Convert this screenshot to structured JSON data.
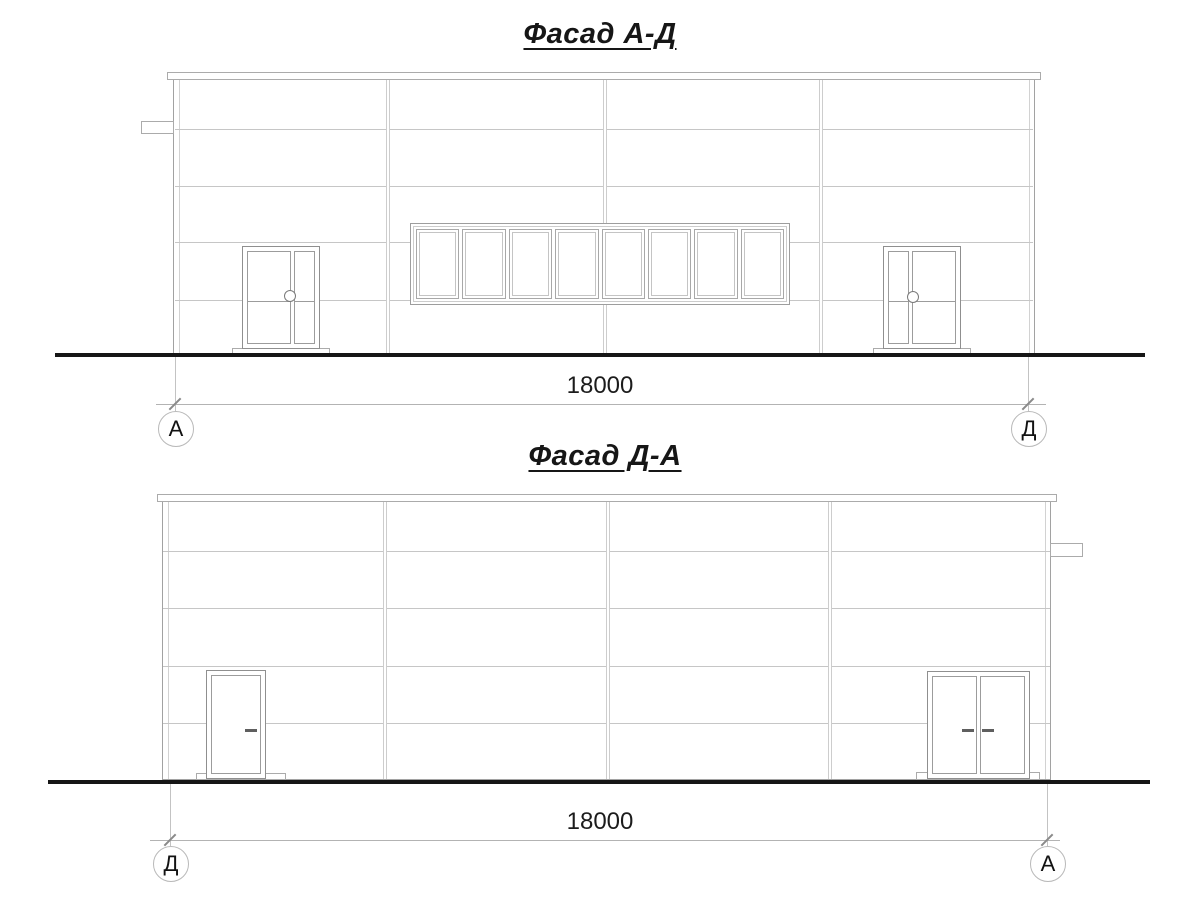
{
  "facade_top": {
    "title": "Фасад А-Д",
    "dimension_label": "18000",
    "axis_left_label": "А",
    "axis_right_label": "Д"
  },
  "facade_bottom": {
    "title": "Фасад Д-А",
    "dimension_label": "18000",
    "axis_left_label": "Д",
    "axis_right_label": "А"
  },
  "colors": {
    "thin_line": "#c6c6c6",
    "outline": "#9d9d9d",
    "ground_line": "#161616",
    "text": "#161616"
  }
}
